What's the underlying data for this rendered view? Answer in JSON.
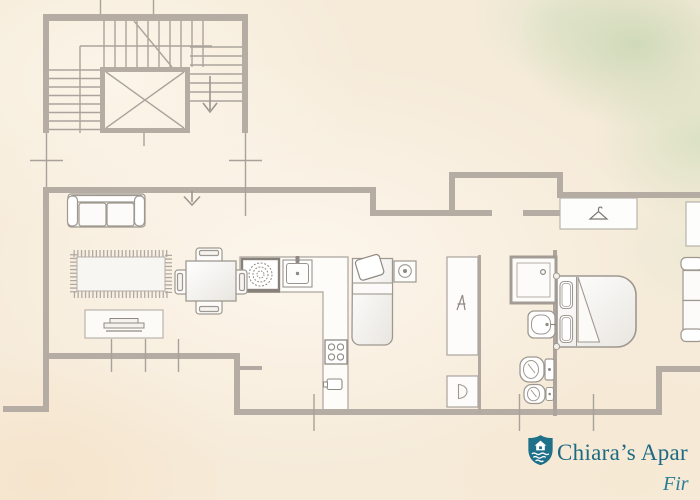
{
  "branding": {
    "title": "Chiara’s Apar",
    "subtitle": "Fir",
    "logo_icon": "shield-house-waves-icon",
    "title_color": "#1d6a84",
    "subtitle_color": "#2a7d93"
  },
  "palette": {
    "background_cream": "#f6ebd9",
    "watercolor_green": "#cdd9b9",
    "watercolor_peach": "#f6e2c8",
    "wall_gray": "#b5aca4",
    "thin_line_gray": "#a9a29b",
    "furniture_fill": "#fdfcfa",
    "furniture_border": "#9e9890"
  },
  "floor_plan": {
    "symbols": [
      "staircase",
      "elevator",
      "entrance-arrow",
      "sofa",
      "rug",
      "tv-console",
      "dining-table",
      "dining-chairs",
      "kitchen-counter",
      "round-hob",
      "kitchen-sink",
      "cooktop-burners",
      "small-appliance",
      "single-bed",
      "washing-machine",
      "tall-cabinet",
      "base-cabinet",
      "shower",
      "washbasin",
      "toilet",
      "bidet",
      "wardrobe-hanger",
      "double-bed",
      "side-sofa",
      "window-ticks"
    ]
  }
}
